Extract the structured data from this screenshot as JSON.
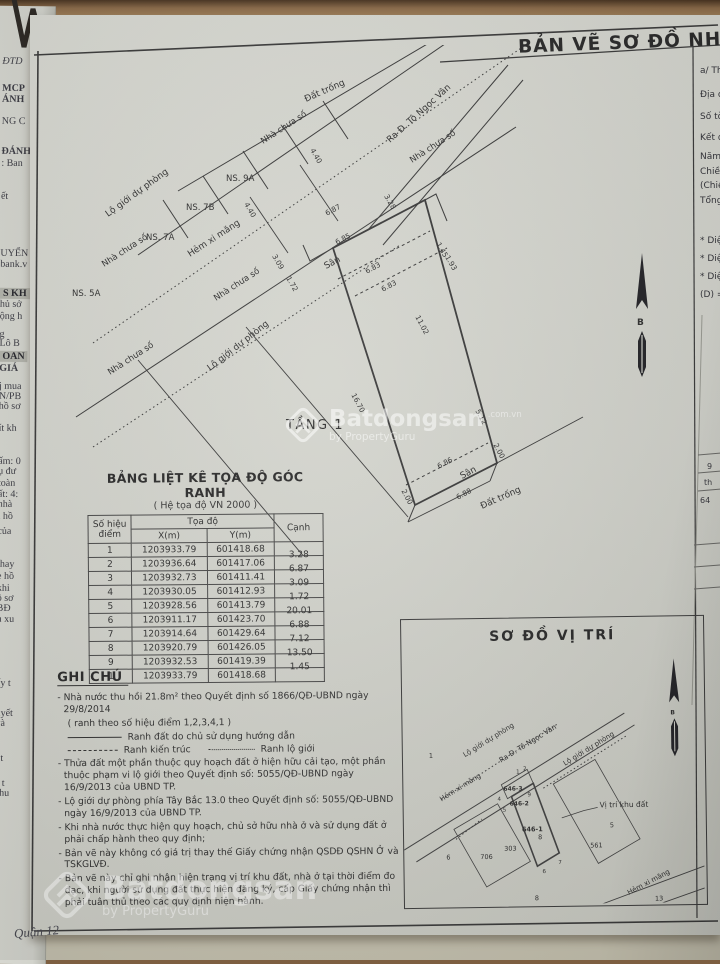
{
  "header": {
    "title": "BẢN VẼ SƠ ĐỒ NHÀ"
  },
  "right_column": {
    "items": [
      "a/ Thông",
      "Địa ch",
      "Số tờ",
      "Kết qu",
      "Năm",
      "Chiều",
      "(Chiề",
      "Tổng",
      "* Diện",
      "* Diện",
      "* Diện",
      "(D) ="
    ],
    "fragments": [
      "9",
      "th",
      "64"
    ]
  },
  "left_margin": {
    "items": [
      "ĐTD",
      "MCP",
      "ÁNH",
      "NG C",
      "ĐÁNH",
      ": Ban",
      "ết",
      "UYỂN",
      "bank.v",
      "S KH",
      "hủ sở",
      "ộng h",
      "g",
      "Lô B",
      "OAN",
      "GIÁ",
      "j mua",
      "N/PB",
      "hồ sơ",
      "ít kh",
      "ấm: 0",
      "ụ đư",
      "toàn",
      "ất: 4:",
      "nhà",
      "i hồ",
      "của",
      "thay",
      "e hồ",
      "khi",
      "ồ sơ",
      "BĐ",
      "n xu",
      "ấy t",
      "uyết",
      "và",
      "í t",
      "ế t",
      "chu"
    ]
  },
  "drawing": {
    "labels": {
      "lo_gioi": "Lộ giới dự phòng",
      "street": "Ra Đ. Tô Ngọc Vân",
      "hem": "Hẻm xi măng",
      "dat_trong": "Đất trống",
      "nha_chua_so": "Nhà chưa số",
      "tang1": "TẦNG 1",
      "san": "Sân"
    },
    "houses": {
      "ns9a": "NS. 9A",
      "ns7b": "NS. 7B",
      "ns7a": "NS. 7A",
      "ns5a": "NS. 5A"
    },
    "north": "B",
    "dims": [
      "4.40",
      "4.40",
      "6.87",
      "3.28",
      "6.85",
      "1.45",
      "1.93",
      "3.09",
      "1.72",
      "6.83",
      "6.83",
      "11.02",
      "16.70",
      "5.12",
      "6.86",
      "6.88",
      "2.00",
      "2.00"
    ]
  },
  "table": {
    "title": "BẢNG LIỆT KÊ TỌA ĐỘ GÓC RANH",
    "subtitle": "( Hệ tọa độ VN 2000 )",
    "col_point": "Số hiệu điểm",
    "col_coord": "Tọa độ",
    "col_x": "X(m)",
    "col_y": "Y(m)",
    "col_edge": "Cạnh",
    "rows": [
      [
        "1",
        "1203933.79",
        "601418.68",
        "3.28"
      ],
      [
        "2",
        "1203936.64",
        "601417.06",
        "6.87"
      ],
      [
        "3",
        "1203932.73",
        "601411.41",
        "3.09"
      ],
      [
        "4",
        "1203930.05",
        "601412.93",
        "1.72"
      ],
      [
        "5",
        "1203928.56",
        "601413.79",
        "20.01"
      ],
      [
        "6",
        "1203911.17",
        "601423.70",
        "6.88"
      ],
      [
        "7",
        "1203914.64",
        "601429.64",
        "7.12"
      ],
      [
        "8",
        "1203920.79",
        "601426.05",
        "13.50"
      ],
      [
        "9",
        "1203932.53",
        "601419.39",
        "1.45"
      ],
      [
        "1",
        "1203933.79",
        "601418.68",
        ""
      ]
    ]
  },
  "notes": {
    "heading": "GHI CHÚ",
    "items": [
      "Nhà nước thu hồi 21.8m² theo Quyết định số 1866/QĐ-UBND ngày 29/8/2014",
      "( ranh theo số hiệu điểm 1,2,3,4,1 )",
      "Thửa đất một phần thuộc quy hoạch đất ở hiện hữu cải tạo, một phần thuộc phạm vi lộ giới theo Quyết định số: 5055/QĐ-UBND ngày 16/9/2013 của UBND TP.",
      "Lộ giới dự phòng phía Tây Bắc 13.0 theo Quyết định số: 5055/QĐ-UBND ngày 16/9/2013 của UBND TP.",
      "Khi nhà nước thực hiện quy hoạch, chủ sở hữu nhà ở và sử dụng đất ở phải chấp hành theo quy định;",
      "Bản vẽ này không có giá trị thay thế Giấy chứng nhận QSDĐ QSHN Ở và TSKGLVĐ.",
      "Bản vẽ này chỉ ghi nhận hiện trạng vị trí khu đất, nhà ở tại thời điểm đo đạc, khi người sử dụng đất thực hiện đăng ký, cấp Giấy chứng nhận thì phải tuân thủ theo các quy định hiện hành."
    ],
    "legend": {
      "line1": "Ranh đất do chủ sử dụng hướng dẫn",
      "line2": "Ranh kiến trúc",
      "line3": "Ranh lộ giới"
    }
  },
  "site_map": {
    "title": "SƠ ĐỒ VỊ TRÍ",
    "lo_gioi": "Lộ giới dự phòng",
    "street": "Ra Đ. Tô Ngọc Vân",
    "hem": "Hẻm xi măng",
    "vi_tri": "Vị trí khu đất",
    "parcels": {
      "a": "646-3",
      "b": "646-2",
      "c": "646-1",
      "d": "706",
      "e": "303",
      "f": "561"
    },
    "numbers": {
      "n1": "1",
      "n5": "5",
      "n6": "6",
      "n8": "8",
      "n8b": "8",
      "n13": "13"
    },
    "points": [
      "1",
      "2",
      "4",
      "9",
      "5",
      "7",
      "6"
    ]
  },
  "watermark": {
    "brand": "Batdongsan",
    "suffix": ".com.vn",
    "byline": "by PropertyGuru"
  },
  "footer": {
    "district": "Quận 12"
  }
}
